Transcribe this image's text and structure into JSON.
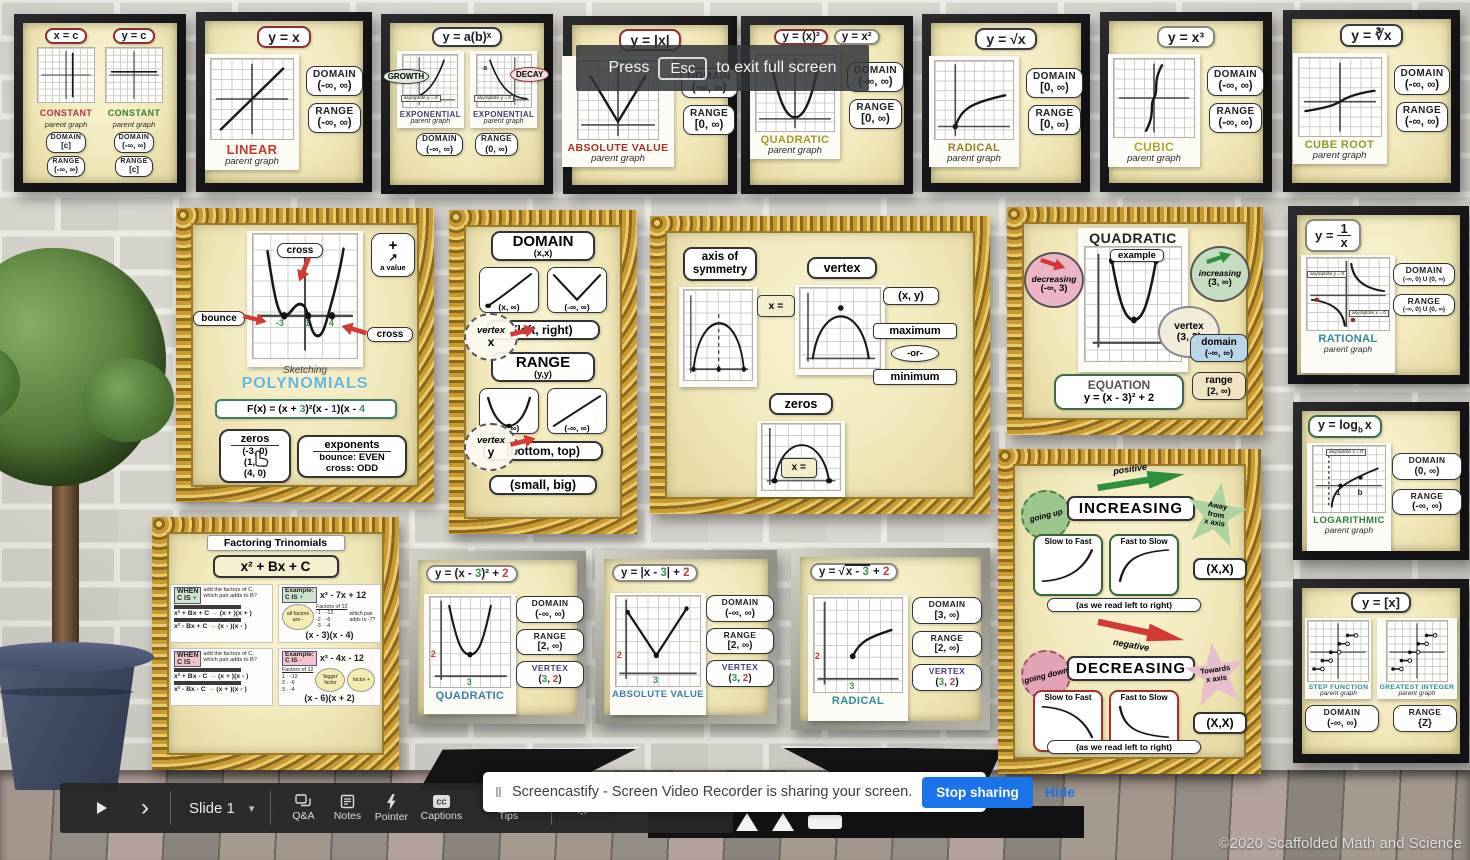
{
  "labels": {
    "domain": "DOMAIN",
    "range": "RANGE",
    "vertex": "VERTEX",
    "parent_graph": "parent graph"
  },
  "esc_overlay": {
    "press": "Press",
    "key": "Esc",
    "rest": "to exit full screen"
  },
  "screencastify": {
    "handle": "‖",
    "message": "Screencastify - Screen Video Recorder is sharing your screen.",
    "stop_button": "Stop sharing",
    "hide_link": "Hide",
    "accent": "#1a73e8"
  },
  "toolbar": {
    "play": "▶",
    "next": "›",
    "slide_label": "Slide 1",
    "caret": "▾",
    "items": [
      "Q&A",
      "Notes",
      "Pointer",
      "Captions",
      "Tips"
    ]
  },
  "copyright": "©2020 Scaffolded Math and Science",
  "frames": {
    "constant": {
      "eq1": "x = c",
      "eq2": "y = c",
      "title": "CONSTANT",
      "domain1": "[c]",
      "range1": "(-∞, ∞)",
      "domain2": "(-∞, ∞)",
      "range2": "[c]",
      "title1_color": "#b03545",
      "title2_color": "#3f7d3a"
    },
    "linear": {
      "eq": "y = x",
      "title": "LINEAR",
      "domain": "(-∞, ∞)",
      "range": "(-∞, ∞)",
      "title_color": "#c0392b"
    },
    "exponential": {
      "eq": "y = a(b)ˣ",
      "growth": "GROWTH",
      "decay": "DECAY",
      "title": "EXPONENTIAL",
      "ab": "ab",
      "a": "a",
      "asymptote": "asymptote y = 0",
      "domain": "(-∞, ∞)",
      "range": "(0, ∞)",
      "title_color": "#43406e"
    },
    "absolute": {
      "eq": "y = |x|",
      "title": "ABSOLUTE VALUE",
      "domain": "(-∞, ∞)",
      "range": "[0, ∞)",
      "title_color": "#a93226"
    },
    "quadratic": {
      "eq1": "y = (x)²",
      "eq2": "y = x²",
      "title": "QUADRATIC",
      "domain": "(-∞, ∞)",
      "range": "[0, ∞)",
      "title_color": "#a89a28"
    },
    "radical": {
      "eq": "y = √x",
      "title": "RADICAL",
      "domain": "[0, ∞)",
      "range": "[0, ∞)",
      "title_color": "#9a7c22"
    },
    "cubic": {
      "eq": "y = x³",
      "title": "CUBIC",
      "domain": "(-∞, ∞)",
      "range": "(-∞, ∞)",
      "title_color": "#b0a42c"
    },
    "cube_root": {
      "eq": "y = ∛x",
      "title": "CUBE ROOT",
      "domain": "(-∞, ∞)",
      "range": "(-∞, ∞)",
      "title_color": "#8f9a2a"
    },
    "polynomials": {
      "sketching": "Sketching",
      "title": "POLYNOMIALS",
      "bounce": "bounce",
      "cross1": "cross",
      "cross2": "cross",
      "plus": "+",
      "a_value": "a value",
      "z1": "-3",
      "z2": "1",
      "z3": "4",
      "eq_parts": [
        "F(x) = (x + ",
        "3",
        ")²(x - ",
        "1",
        ")(x - ",
        "4",
        ")"
      ],
      "zeros_header": "zeros",
      "zeros": [
        "(-3, 0)",
        "(1, 0)",
        "(4, 0)"
      ],
      "exp_header": "exponents",
      "bounce_k": "bounce:",
      "bounce_v": "EVEN",
      "cross_k": "cross:",
      "cross_v": "ODD"
    },
    "domain_range": {
      "domain_title": "DOMAIN",
      "domain_sub": "(x,x)",
      "card1": "(x, ∞)",
      "card2": "(-∞, ∞)",
      "vertex_word": "vertex",
      "vx": "x",
      "vy": "y",
      "left_right": "(left, right)",
      "range_title": "RANGE",
      "range_sub": "(y,y)",
      "card3": "(y, ∞)",
      "card4": "(-∞, ∞)",
      "bottom_top": "(bottom, top)",
      "small_big": "(small, big)"
    },
    "features": {
      "axis1": "axis of",
      "axis2": "symmetry",
      "axis_eq": "x =",
      "vertex": "vertex",
      "vertex_val": "(x, y)",
      "maximum": "maximum",
      "or": "-or-",
      "minimum": "minimum",
      "zeros": "zeros",
      "zeros_eq": "x ="
    },
    "quad_example": {
      "title": "QUADRATIC",
      "example": "example",
      "dec": "decreasing",
      "dec_val": "(-∞, 3)",
      "inc": "increasing",
      "inc_val": "(3, ∞)",
      "vertex": "vertex",
      "vertex_val": "(3, 2)",
      "domain": "domain",
      "domain_val": "(-∞, ∞)",
      "range": "range",
      "range_val": "[2, ∞)",
      "eq_label": "EQUATION",
      "eq": "y = (x - 3)² + 2"
    },
    "rational": {
      "eq_y": "y =",
      "num": "1",
      "den": "x",
      "asym1": "asymptote y = 0",
      "asym2": "asymptote x = 0",
      "title": "RATIONAL",
      "domain": "(-∞, 0) U (0, ∞)",
      "range": "(-∞, 0) U (0, ∞)",
      "title_color": "#2e8b9a"
    },
    "logarithmic": {
      "eq_pre": "y = log",
      "eq_sub": "b",
      "eq_x": "x",
      "asym": "asymptote x = 0",
      "one": "1",
      "b": "b",
      "title": "LOGARITHMIC",
      "domain": "(0, ∞)",
      "range": "(-∞, ∞)",
      "title_color": "#2e7d46"
    },
    "step": {
      "eq": "y = [x]",
      "title1": "STEP FUNCTION",
      "title2": "GREATEST INTEGER",
      "domain": "(-∞, ∞)",
      "range": "{Z}",
      "title_color": "#2e8b9a"
    },
    "factoring": {
      "title": "Factoring Trinomials",
      "formula": "x² + Bx + C",
      "when": "WHEN",
      "cis": "C IS",
      "plus": "+",
      "minus": "-",
      "add_text": "add the factors of C, which pair adds to B?",
      "arrow": "→",
      "p_r1a": "x² + Bx + C",
      "p_r1b": "(x + )(x + )",
      "p_r2a": "x² - Bx + C",
      "p_r2b": "(x - )(x - )",
      "example": "Example:",
      "ex_p_eq": "x² - 7x + 12",
      "all_neg": "all factors are -",
      "factors_of": "Factors of 12",
      "p_factors": [
        "-1 · -12",
        "-2 · -6",
        "-3 · -4"
      ],
      "which": "which pair adds to -7?",
      "p_ans": "(x - 3)(x - 4)",
      "m_r1a": "x² + Bx - C",
      "m_r1b": "(x + )(x - )",
      "m_r2a": "x² - Bx - C",
      "m_r2b": "(x + )(x - )",
      "ex_m_eq": "x² - 4x - 12",
      "m_factors": [
        "1 · -12",
        "2 · -6",
        "3 · -4"
      ],
      "bigger": "'bigger' factor",
      "factor_plus": "factor +",
      "m_ans": "(x - 6)(x + 2)"
    },
    "t_quadratic": {
      "eq": [
        "y = (x - ",
        "3",
        ")² + ",
        "2"
      ],
      "title": "QUADRATIC",
      "domain": "(-∞, ∞)",
      "range": "[2, ∞)",
      "vertex": [
        "(",
        "3",
        ", ",
        "2",
        ")"
      ],
      "mx": "3",
      "my": "2",
      "title_color": "#3a7fae"
    },
    "t_absolute": {
      "eq": [
        "y = |x - ",
        "3",
        "| + ",
        "2"
      ],
      "title": "ABSOLUTE VALUE",
      "domain": "(-∞, ∞)",
      "range": "[2, ∞)",
      "vertex": [
        "(",
        "3",
        ", ",
        "2",
        ")"
      ],
      "mx": "3",
      "my": "2",
      "title_color": "#3a7fae"
    },
    "t_radical": {
      "eq_pre": "y = √",
      "eq_rad1": "x - ",
      "eq_rad_n": "3",
      "eq_post": " + ",
      "eq_n2": "2",
      "title": "RADICAL",
      "domain": "[3, ∞)",
      "range": "[2, ∞)",
      "vertex": [
        "(",
        "3",
        ", ",
        "2",
        ")"
      ],
      "mx": "3",
      "my": "2",
      "title_color": "#2e8b9a"
    },
    "inc_dec": {
      "positive": "positive",
      "going_up": "going up",
      "increasing": "INCREASING",
      "away1": "Away",
      "away2": "from",
      "away3": "x axis",
      "slow_fast": "Slow to Fast",
      "fast_slow": "Fast to Slow",
      "xx": "(X,X)",
      "note": "(as we read left to right)",
      "negative": "negative",
      "going_down": "going down",
      "decreasing": "DECREASING",
      "towards1": "Towards",
      "towards2": "x axis"
    }
  }
}
